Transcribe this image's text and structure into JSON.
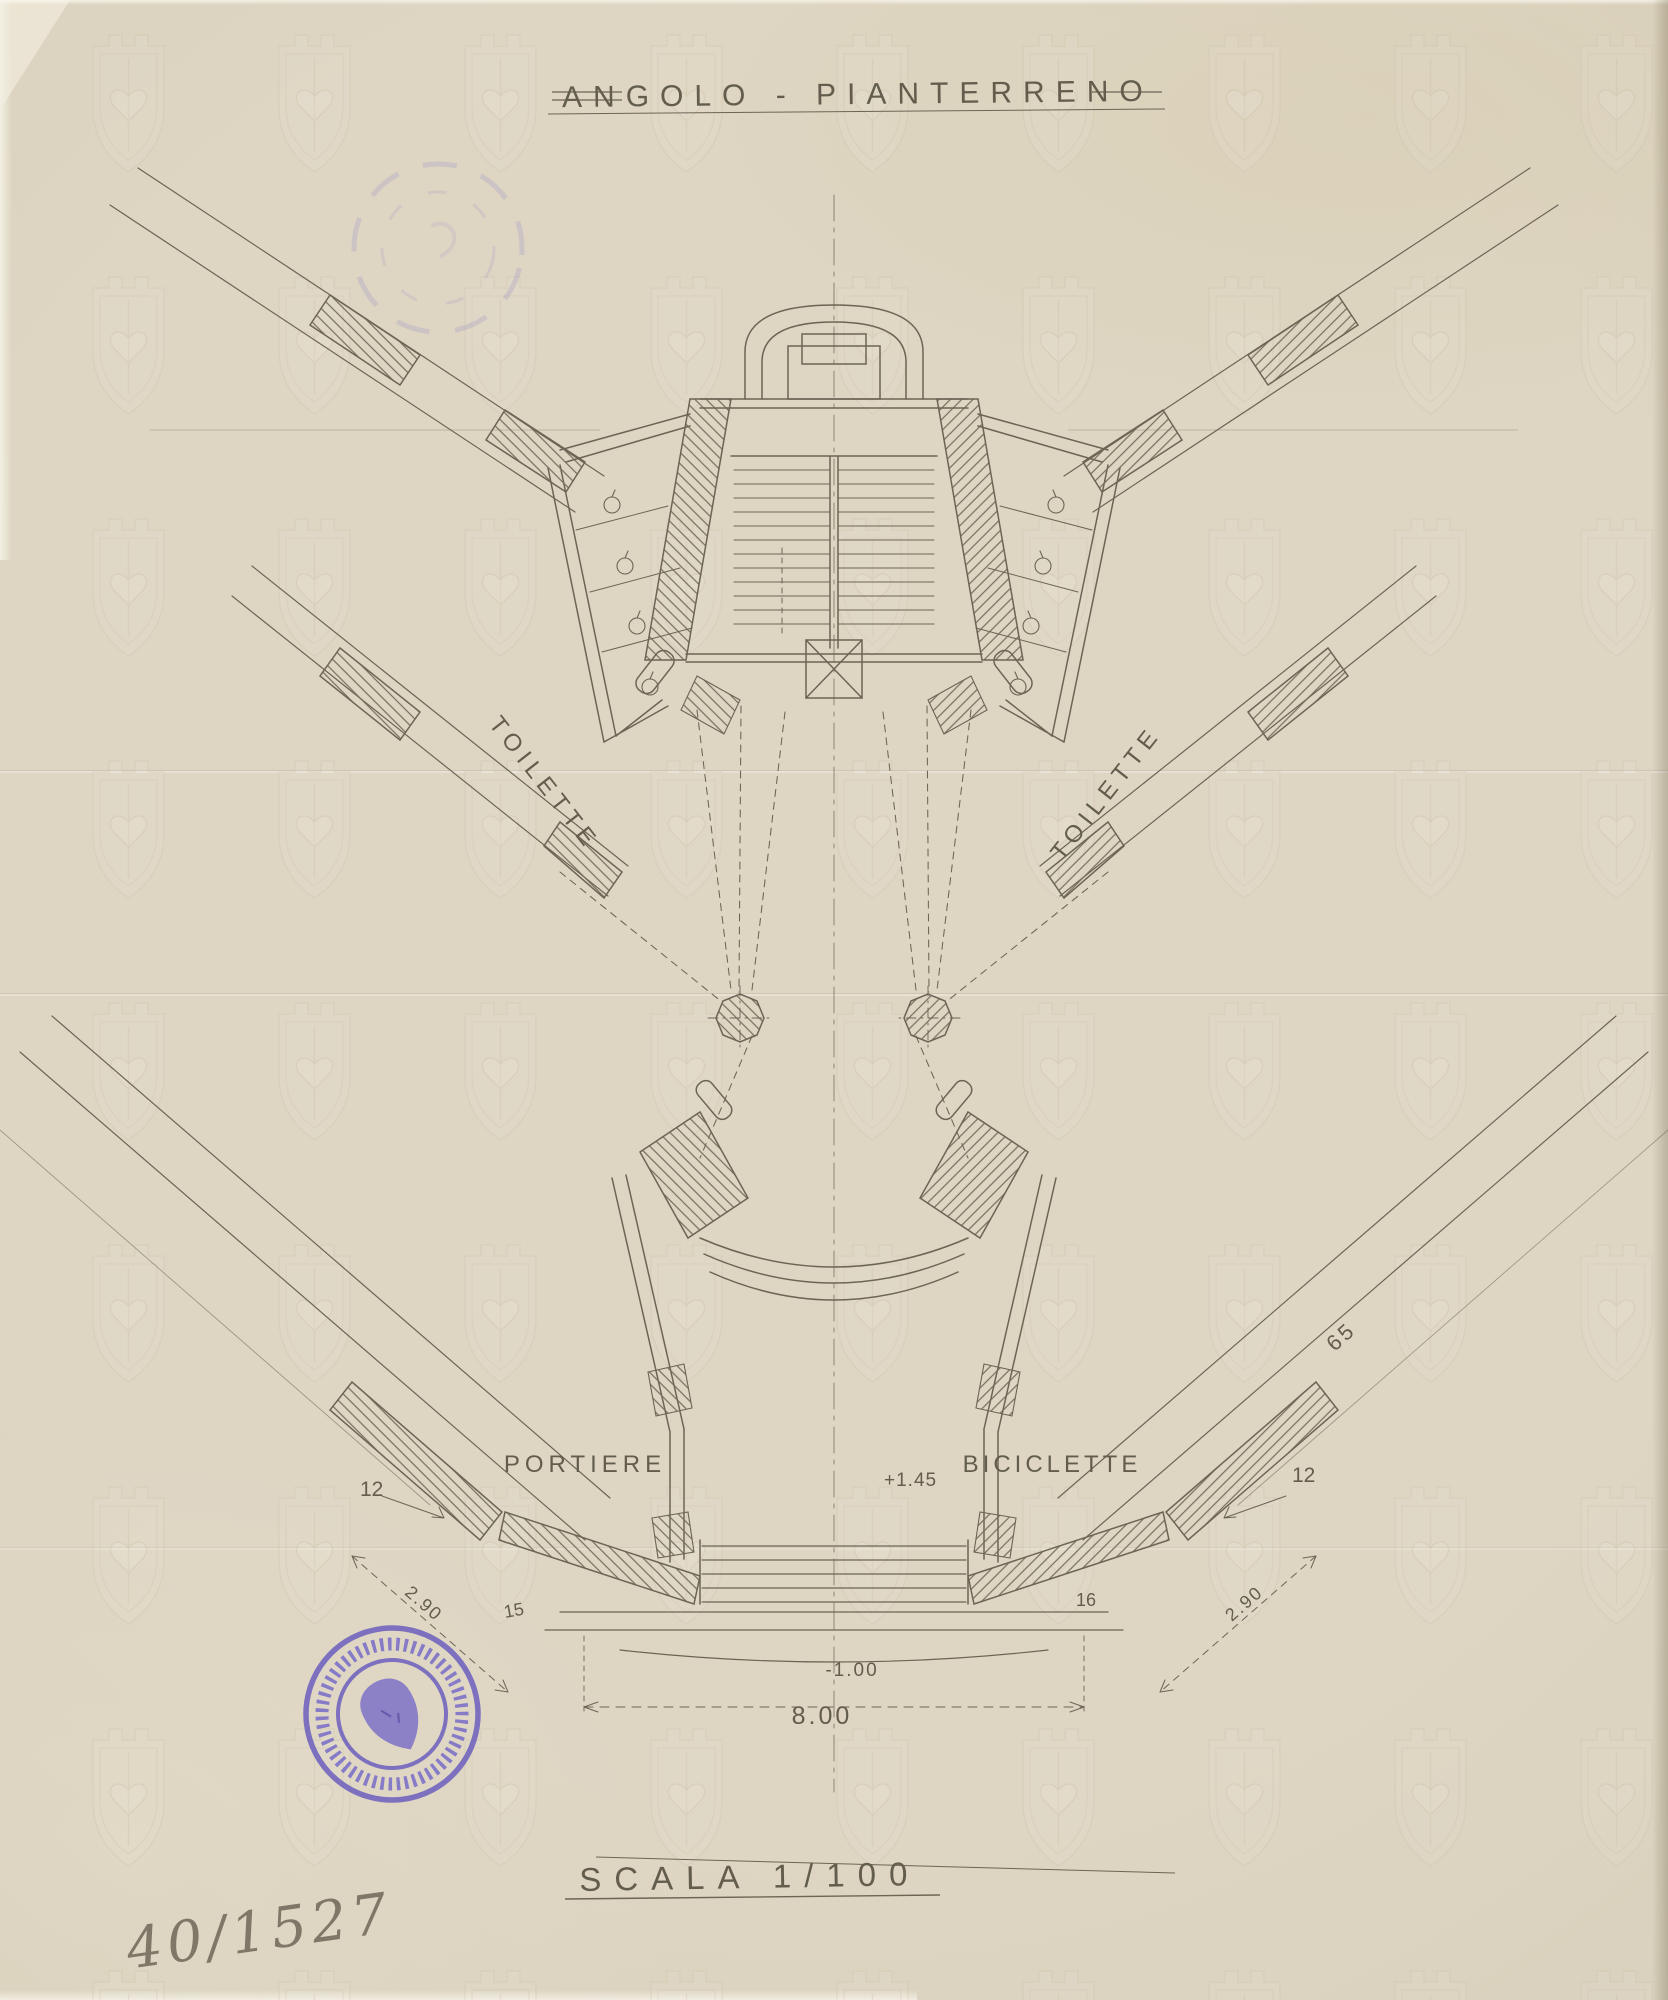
{
  "doc": {
    "title": "ANGOLO - PIANTERRENO",
    "scale_label": "SCALA 1/100",
    "inventory_number": "40/1527"
  },
  "labels": {
    "toilette_left": "TOILETTE",
    "toilette_right": "TOILETTE",
    "portiere": "PORTIERE",
    "biciclette": "BICICLETTE"
  },
  "dims": {
    "wall_left": "12",
    "step_left": "15",
    "span_left": "2.90",
    "wall_right": "12",
    "step_right": "16",
    "span_right": "2.90",
    "wing": "65",
    "width": "8.00",
    "level_low": "-1.00",
    "level_high": "+1.45"
  },
  "colors": {
    "paper": "#dcd4c0",
    "ink": "#6c6555",
    "stamp_purple": "#7468bf",
    "pencil": "#6f6759"
  }
}
